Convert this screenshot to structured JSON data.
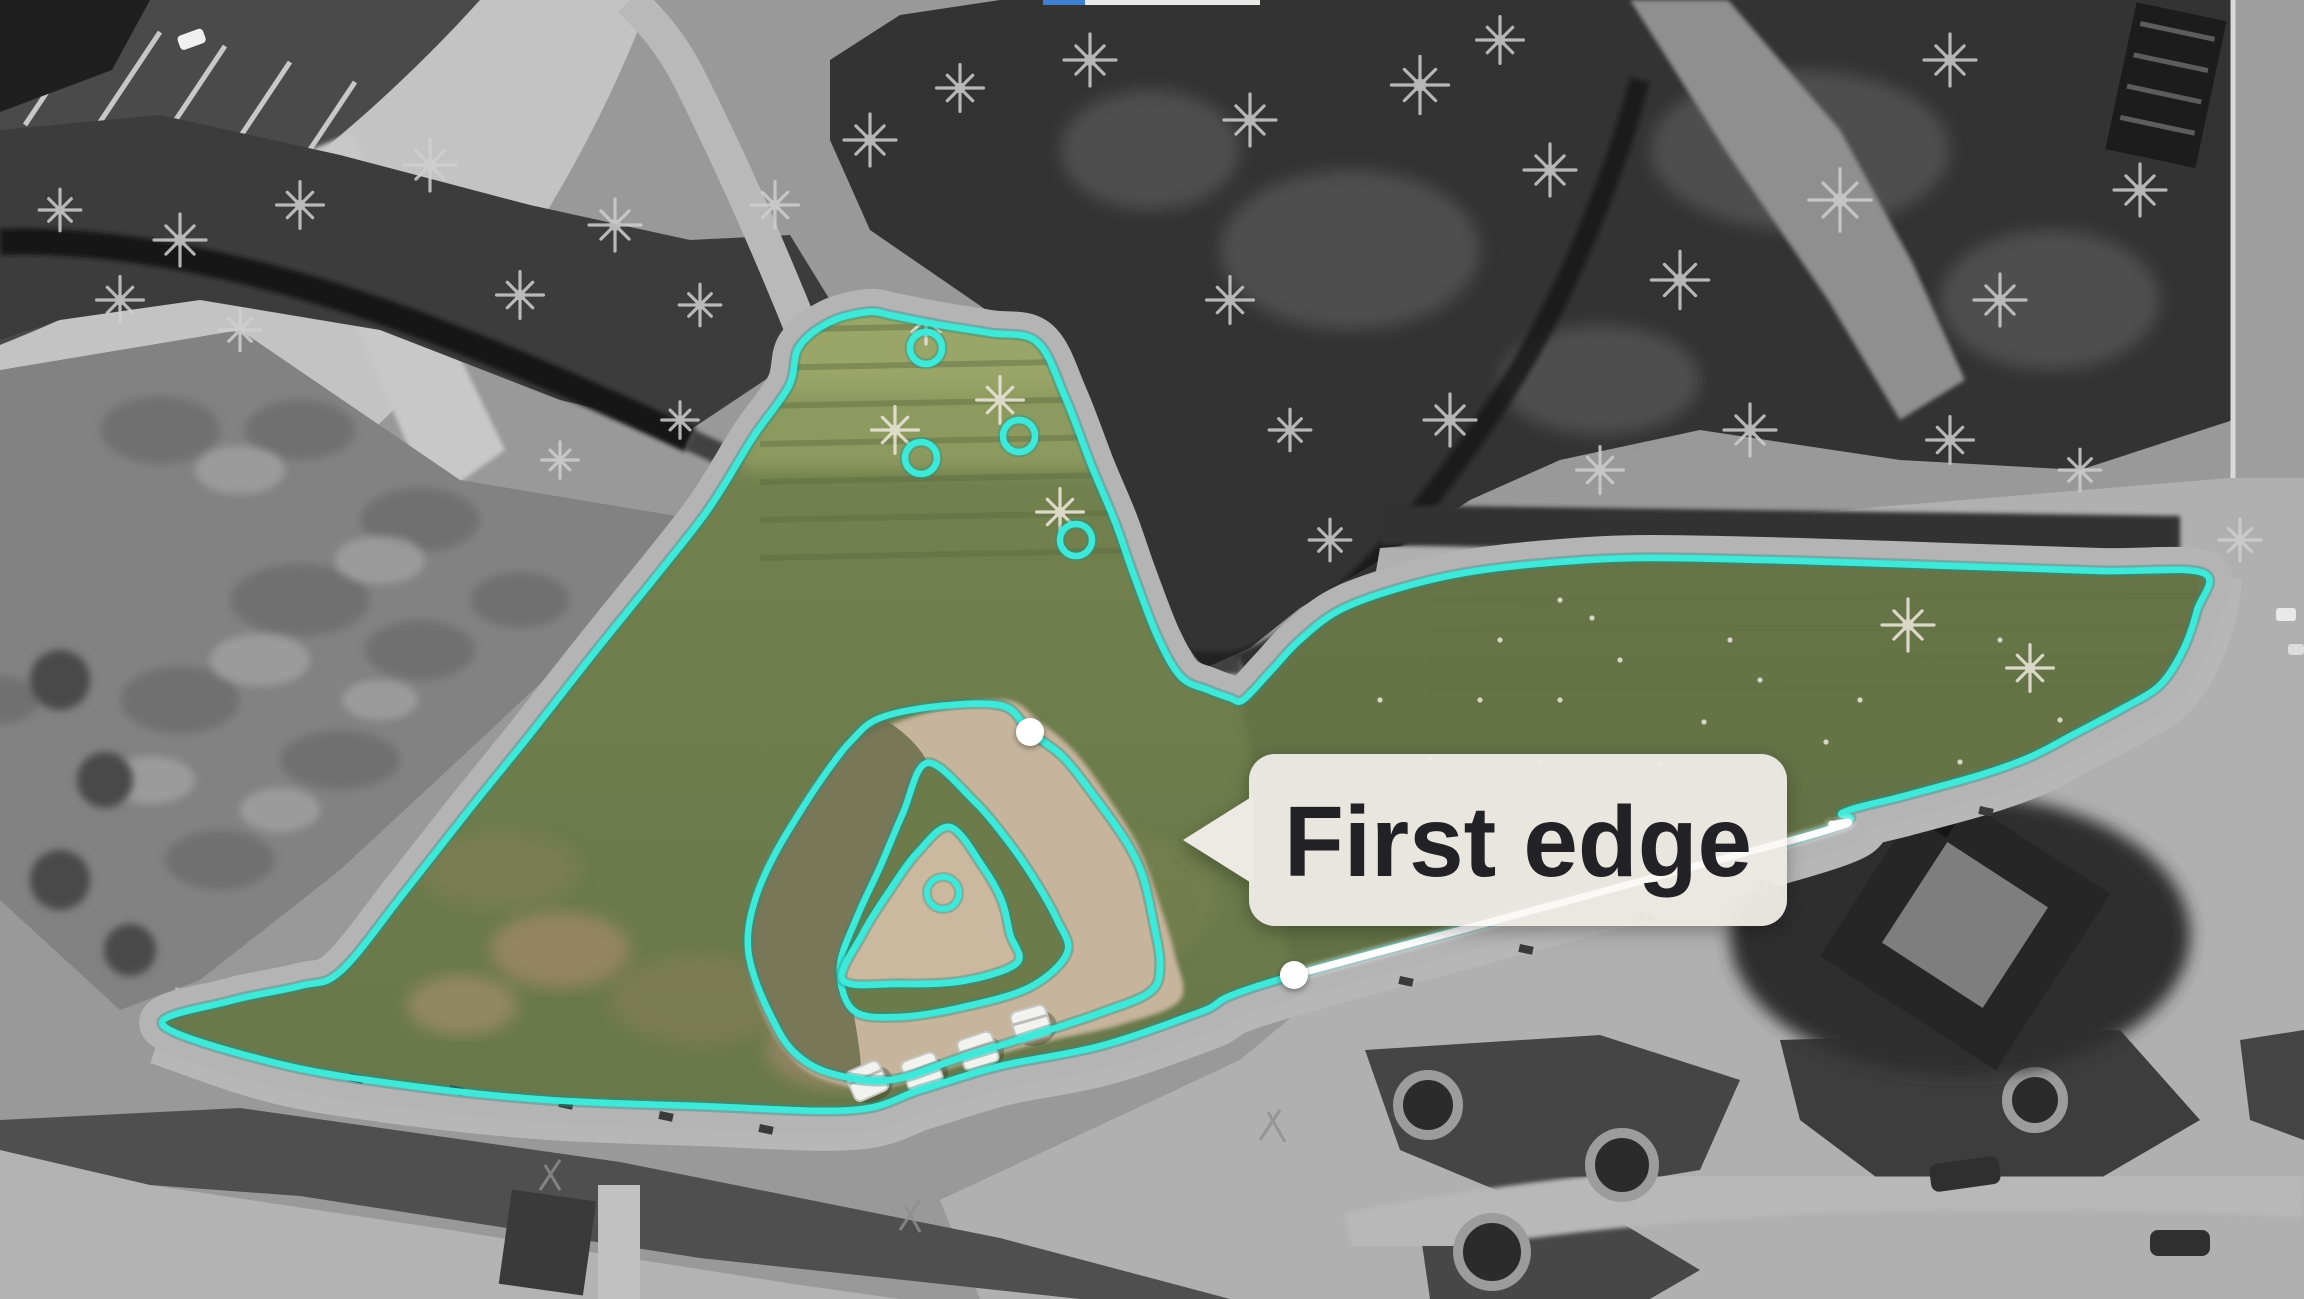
{
  "label": {
    "text": "First edge"
  },
  "overlay": {
    "accent_color": "#3fe9d9",
    "accent_under_color": "#0d9a91",
    "white_color": "#ffffff",
    "label_bg_color": "#edeae4",
    "label_text_color": "#222226",
    "progress_bar": {
      "x": 1043,
      "y": 0,
      "h": 5,
      "blue_w": 42,
      "light_w": 175,
      "blue": "#3f7fd2",
      "light": "#e9e9e7"
    },
    "outer_boundary": [
      [
        163,
        1025
      ],
      [
        230,
        1001
      ],
      [
        300,
        986
      ],
      [
        341,
        971
      ],
      [
        404,
        893
      ],
      [
        466,
        814
      ],
      [
        529,
        736
      ],
      [
        591,
        657
      ],
      [
        654,
        579
      ],
      [
        700,
        521
      ],
      [
        723,
        487
      ],
      [
        754,
        436
      ],
      [
        789,
        386
      ],
      [
        799,
        347
      ],
      [
        830,
        322
      ],
      [
        868,
        312
      ],
      [
        894,
        316
      ],
      [
        940,
        325
      ],
      [
        990,
        333
      ],
      [
        1037,
        342
      ],
      [
        1065,
        397
      ],
      [
        1092,
        467
      ],
      [
        1115,
        522
      ],
      [
        1134,
        576
      ],
      [
        1158,
        638
      ],
      [
        1181,
        677
      ],
      [
        1208,
        690
      ],
      [
        1230,
        698
      ],
      [
        1243,
        700
      ],
      [
        1270,
        672
      ],
      [
        1300,
        640
      ],
      [
        1340,
        610
      ],
      [
        1400,
        588
      ],
      [
        1470,
        572
      ],
      [
        1560,
        562
      ],
      [
        1650,
        558
      ],
      [
        1800,
        561
      ],
      [
        1950,
        566
      ],
      [
        2100,
        571
      ],
      [
        2203,
        573
      ],
      [
        2197,
        610
      ],
      [
        2183,
        650
      ],
      [
        2160,
        685
      ],
      [
        2125,
        707
      ],
      [
        2076,
        733
      ],
      [
        2030,
        757
      ],
      [
        1980,
        775
      ],
      [
        1900,
        797
      ],
      [
        1844,
        812
      ],
      [
        1800,
        838
      ],
      [
        1294,
        975
      ],
      [
        1200,
        1012
      ],
      [
        1100,
        1046
      ],
      [
        1000,
        1066
      ],
      [
        920,
        1090
      ],
      [
        852,
        1110
      ],
      [
        700,
        1106
      ],
      [
        550,
        1100
      ],
      [
        412,
        1086
      ],
      [
        280,
        1064
      ]
    ],
    "sidewalk_line": [
      [
        163,
        1025
      ],
      [
        280,
        1064
      ],
      [
        412,
        1086
      ],
      [
        550,
        1100
      ],
      [
        700,
        1106
      ],
      [
        852,
        1110
      ],
      [
        920,
        1090
      ],
      [
        1000,
        1066
      ],
      [
        1100,
        1046
      ],
      [
        1200,
        1012
      ],
      [
        1294,
        975
      ],
      [
        1800,
        838
      ],
      [
        1844,
        812
      ],
      [
        1900,
        797
      ],
      [
        1980,
        775
      ],
      [
        2030,
        757
      ],
      [
        2076,
        733
      ],
      [
        2125,
        707
      ],
      [
        2160,
        685
      ],
      [
        2183,
        650
      ],
      [
        2197,
        610
      ],
      [
        2203,
        573
      ]
    ],
    "first_edge_line": [
      [
        1294,
        975
      ],
      [
        1800,
        838
      ],
      [
        1832,
        824
      ]
    ],
    "vertex_dots": [
      [
        1030,
        732
      ],
      [
        1294,
        975
      ]
    ],
    "dot_radius": 14,
    "mound_rings": {
      "outer": [
        [
          880,
          718
        ],
        [
          940,
          706
        ],
        [
          1003,
          706
        ],
        [
          1030,
          732
        ],
        [
          1063,
          757
        ],
        [
          1097,
          800
        ],
        [
          1127,
          843
        ],
        [
          1143,
          877
        ],
        [
          1153,
          920
        ],
        [
          1160,
          965
        ],
        [
          1150,
          992
        ],
        [
          1100,
          1013
        ],
        [
          1040,
          1033
        ],
        [
          960,
          1058
        ],
        [
          890,
          1080
        ],
        [
          830,
          1073
        ],
        [
          793,
          1051
        ],
        [
          770,
          1014
        ],
        [
          752,
          969
        ],
        [
          748,
          934
        ],
        [
          757,
          894
        ],
        [
          775,
          854
        ],
        [
          800,
          812
        ],
        [
          828,
          770
        ],
        [
          852,
          740
        ]
      ],
      "middle": [
        [
          927,
          763
        ],
        [
          973,
          800
        ],
        [
          1007,
          840
        ],
        [
          1034,
          879
        ],
        [
          1057,
          920
        ],
        [
          1067,
          953
        ],
        [
          1030,
          987
        ],
        [
          963,
          1007
        ],
        [
          897,
          1017
        ],
        [
          853,
          1010
        ],
        [
          840,
          967
        ],
        [
          857,
          917
        ],
        [
          880,
          867
        ],
        [
          903,
          813
        ]
      ],
      "inner": [
        [
          950,
          827
        ],
        [
          983,
          867
        ],
        [
          1002,
          901
        ],
        [
          1010,
          934
        ],
        [
          1017,
          963
        ],
        [
          963,
          981
        ],
        [
          897,
          984
        ],
        [
          843,
          980
        ],
        [
          863,
          933
        ],
        [
          890,
          890
        ],
        [
          917,
          853
        ]
      ]
    },
    "center_marker": {
      "cx": 943,
      "cy": 893,
      "r": 16
    },
    "tree_markers": [
      [
        926,
        348
      ],
      [
        1019,
        436
      ],
      [
        921,
        458
      ],
      [
        1076,
        540
      ]
    ],
    "tree_marker_radius": 16,
    "callout": {
      "box_x": 1249,
      "box_y": 754,
      "box_w": 538,
      "box_h": 172,
      "radius": 26,
      "tip": [
        1183,
        840
      ],
      "base_top": [
        1253,
        796
      ],
      "base_bottom": [
        1253,
        884
      ],
      "text_x": 1518,
      "text_y": 876,
      "font_size": 100,
      "text_length": 468
    }
  },
  "scenery": {
    "work_area_base_top": "#79874f",
    "work_area_base_bottom": "#66754a",
    "tan_color": "#c6b49c",
    "tan_blob": [
      [
        928,
        712
      ],
      [
        1005,
        700
      ],
      [
        1040,
        722
      ],
      [
        1075,
        752
      ],
      [
        1110,
        800
      ],
      [
        1140,
        850
      ],
      [
        1160,
        905
      ],
      [
        1175,
        955
      ],
      [
        1180,
        1000
      ],
      [
        1120,
        1025
      ],
      [
        1040,
        1043
      ],
      [
        960,
        1065
      ],
      [
        880,
        1088
      ],
      [
        820,
        1078
      ],
      [
        785,
        1050
      ],
      [
        762,
        1010
      ],
      [
        748,
        960
      ],
      [
        750,
        915
      ],
      [
        765,
        870
      ],
      [
        790,
        825
      ],
      [
        820,
        780
      ],
      [
        860,
        740
      ]
    ],
    "gray_trees": [
      [
        180,
        240,
        1
      ],
      [
        300,
        205,
        0.9
      ],
      [
        430,
        165,
        1
      ],
      [
        520,
        295,
        0.9
      ],
      [
        615,
        225,
        1
      ],
      [
        700,
        305,
        0.8
      ],
      [
        775,
        205,
        0.9
      ],
      [
        870,
        140,
        1
      ],
      [
        960,
        88,
        0.9
      ],
      [
        1090,
        60,
        1
      ],
      [
        1250,
        120,
        1
      ],
      [
        1420,
        85,
        1.1
      ],
      [
        1550,
        170,
        1
      ],
      [
        1680,
        280,
        1.1
      ],
      [
        1840,
        200,
        1.2
      ],
      [
        2000,
        300,
        1
      ],
      [
        2140,
        190,
        1
      ],
      [
        1450,
        420,
        1
      ],
      [
        1600,
        470,
        0.9
      ],
      [
        1750,
        430,
        1
      ],
      [
        1950,
        440,
        0.9
      ],
      [
        2080,
        470,
        0.8
      ],
      [
        1230,
        300,
        0.9
      ],
      [
        1290,
        430,
        0.8
      ],
      [
        1330,
        540,
        0.8
      ],
      [
        680,
        420,
        0.7
      ],
      [
        560,
        460,
        0.7
      ],
      [
        240,
        330,
        0.8
      ],
      [
        120,
        300,
        0.9
      ],
      [
        60,
        210,
        0.8
      ],
      [
        2240,
        540,
        0.8
      ],
      [
        1500,
        40,
        0.9
      ],
      [
        1950,
        60,
        1
      ]
    ],
    "white_trees": [
      [
        926,
        318,
        1
      ],
      [
        1000,
        400,
        0.9
      ],
      [
        895,
        430,
        0.9
      ],
      [
        1060,
        512,
        0.9
      ],
      [
        1908,
        625,
        1
      ],
      [
        2030,
        668,
        0.9
      ],
      [
        2225,
        655,
        0.8
      ]
    ],
    "daisies": [
      [
        1500,
        640
      ],
      [
        1560,
        700
      ],
      [
        1620,
        660
      ],
      [
        1704,
        722
      ],
      [
        1760,
        680
      ],
      [
        1826,
        742
      ],
      [
        1540,
        762
      ],
      [
        1480,
        700
      ],
      [
        1660,
        764
      ],
      [
        1730,
        640
      ],
      [
        1860,
        700
      ],
      [
        1592,
        618
      ],
      [
        2060,
        720
      ],
      [
        1960,
        762
      ],
      [
        1430,
        758
      ],
      [
        1380,
        700
      ],
      [
        2140,
        758
      ],
      [
        1900,
        800
      ],
      [
        2000,
        640
      ],
      [
        1560,
        600
      ]
    ],
    "patches": [
      {
        "x": 560,
        "y": 950,
        "rx": 70,
        "ry": 38,
        "c": "#bd8f78",
        "o": 0.5
      },
      {
        "x": 462,
        "y": 1005,
        "rx": 55,
        "ry": 30,
        "c": "#c49a82",
        "o": 0.45
      },
      {
        "x": 840,
        "y": 1050,
        "rx": 75,
        "ry": 40,
        "c": "#b99079",
        "o": 0.45
      },
      {
        "x": 700,
        "y": 1000,
        "rx": 90,
        "ry": 45,
        "c": "#8b7f5a",
        "o": 0.5
      },
      {
        "x": 500,
        "y": 870,
        "rx": 80,
        "ry": 40,
        "c": "#85805c",
        "o": 0.5
      },
      {
        "x": 1100,
        "y": 900,
        "rx": 120,
        "ry": 70,
        "c": "#77814f",
        "o": 0.55
      }
    ],
    "loungers": [
      {
        "x": 867,
        "y": 1081,
        "a": -24
      },
      {
        "x": 922,
        "y": 1072,
        "a": -20
      },
      {
        "x": 978,
        "y": 1051,
        "a": -18
      },
      {
        "x": 1031,
        "y": 1024,
        "a": -16
      }
    ],
    "sidewalk_dashes": [
      [
        350,
        1073
      ],
      [
        450,
        1085
      ],
      [
        560,
        1099
      ],
      [
        660,
        1111
      ],
      [
        760,
        1124
      ],
      [
        1400,
        976
      ],
      [
        1520,
        944
      ],
      [
        1640,
        912
      ],
      [
        1760,
        880
      ],
      [
        1980,
        806
      ]
    ]
  }
}
